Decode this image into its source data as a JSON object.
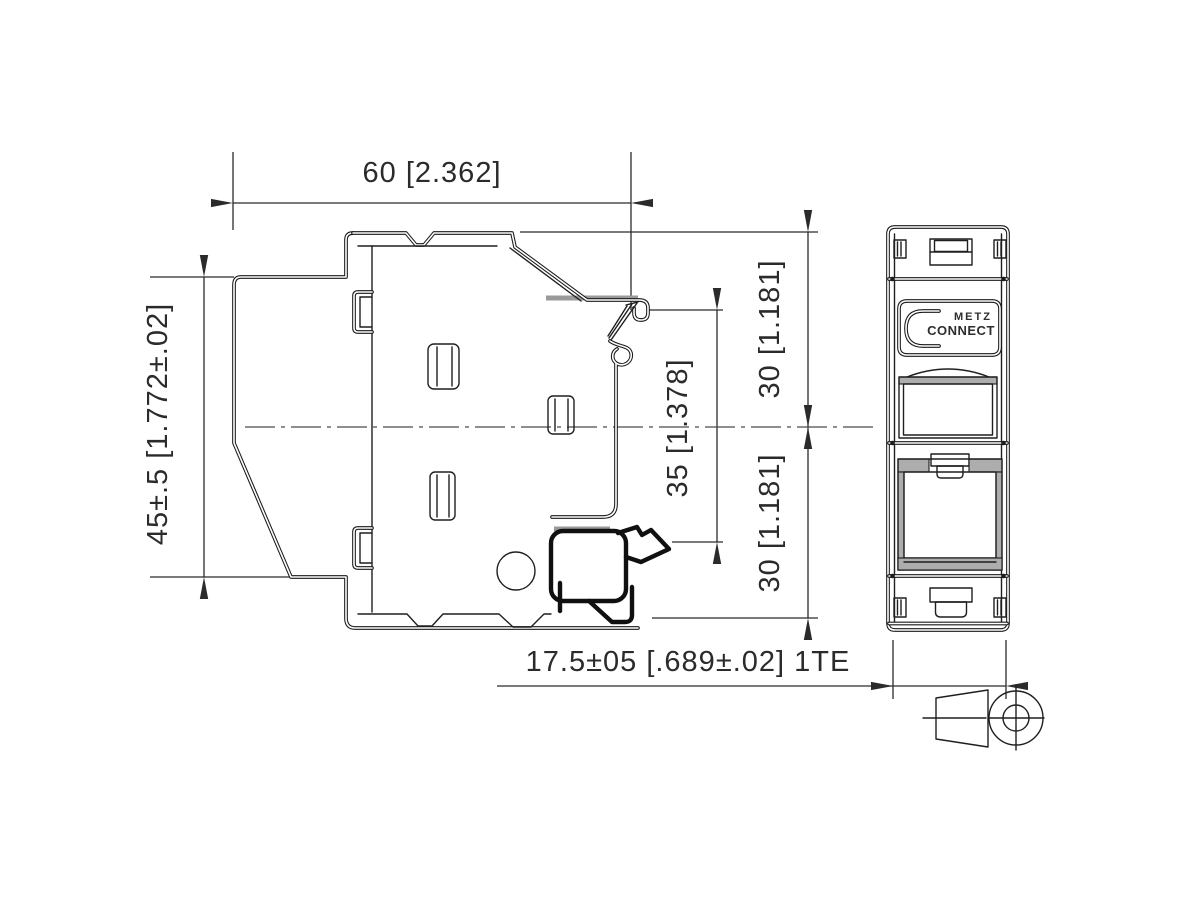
{
  "drawing": {
    "type": "technical-dimensional-drawing",
    "views": {
      "side_view": "DIN-rail mount module side profile",
      "front_view": "1TE module front with two RJ45 jacks"
    },
    "dimensions": {
      "width_top": "60 [2.362]",
      "height_left": "45±.5 [1.772±.02]",
      "rail_center": "35 [1.378]",
      "upper_half": "30 [1.181]",
      "lower_half": "30 [1.181]",
      "module_width": "17.5±05 [.689±.02] 1TE"
    },
    "logo": {
      "line1": "METZ",
      "line2": "CONNECT"
    },
    "colors": {
      "line": "#1a1a1a",
      "dimension": "#2b2b2b",
      "gray_fill": "#adadad",
      "background": "#ffffff"
    }
  }
}
